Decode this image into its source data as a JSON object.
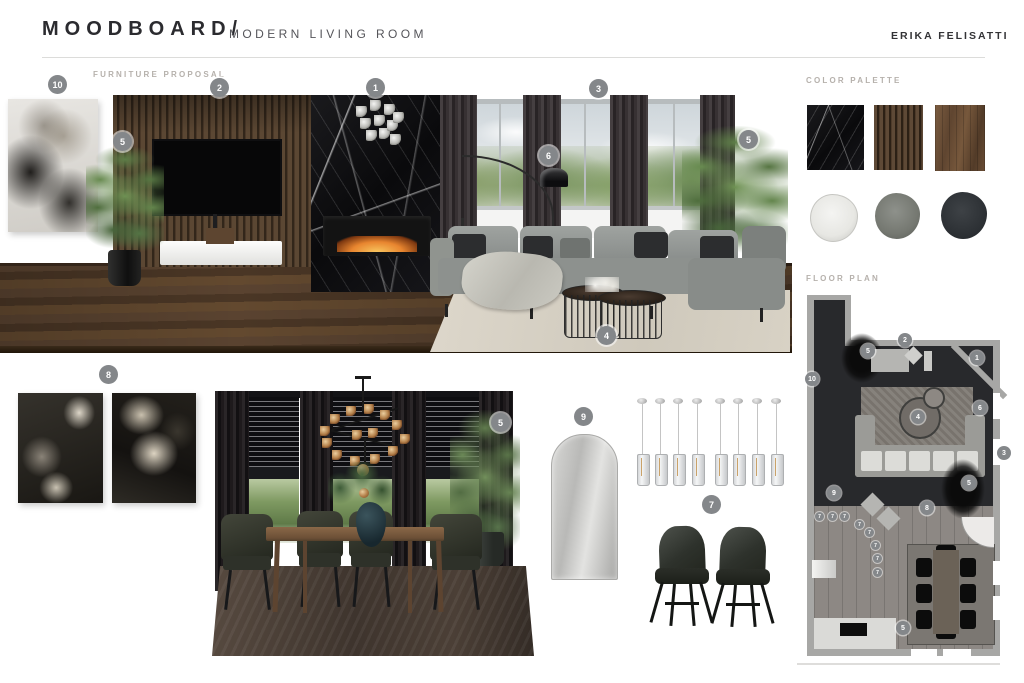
{
  "header": {
    "title": "MOODBOARD/",
    "subtitle": "MODERN LIVING ROOM",
    "author": "ERIKA FELISATTI"
  },
  "sections": {
    "furniture_proposal": "FURNITURE PROPOSAL",
    "color_palette": "COLOR PALETTE",
    "floor_plan": "FLOOR PLAN"
  },
  "badge_numbers": {
    "n1": "1",
    "n2": "2",
    "n3": "3",
    "n4": "4",
    "n5": "5",
    "n6": "6",
    "n7": "7",
    "n8": "8",
    "n9": "9",
    "n10": "10"
  },
  "color_palette": {
    "materials": [
      {
        "name": "black-marble",
        "hex": "#141417"
      },
      {
        "name": "walnut-slat-panel",
        "hex": "#55412f"
      },
      {
        "name": "walnut-wood",
        "hex": "#6d5138"
      }
    ],
    "paints": [
      {
        "name": "off-white",
        "hex": "#ebebe9"
      },
      {
        "name": "warm-gray",
        "hex": "#7b7e79"
      },
      {
        "name": "charcoal",
        "hex": "#2f3337"
      }
    ]
  }
}
